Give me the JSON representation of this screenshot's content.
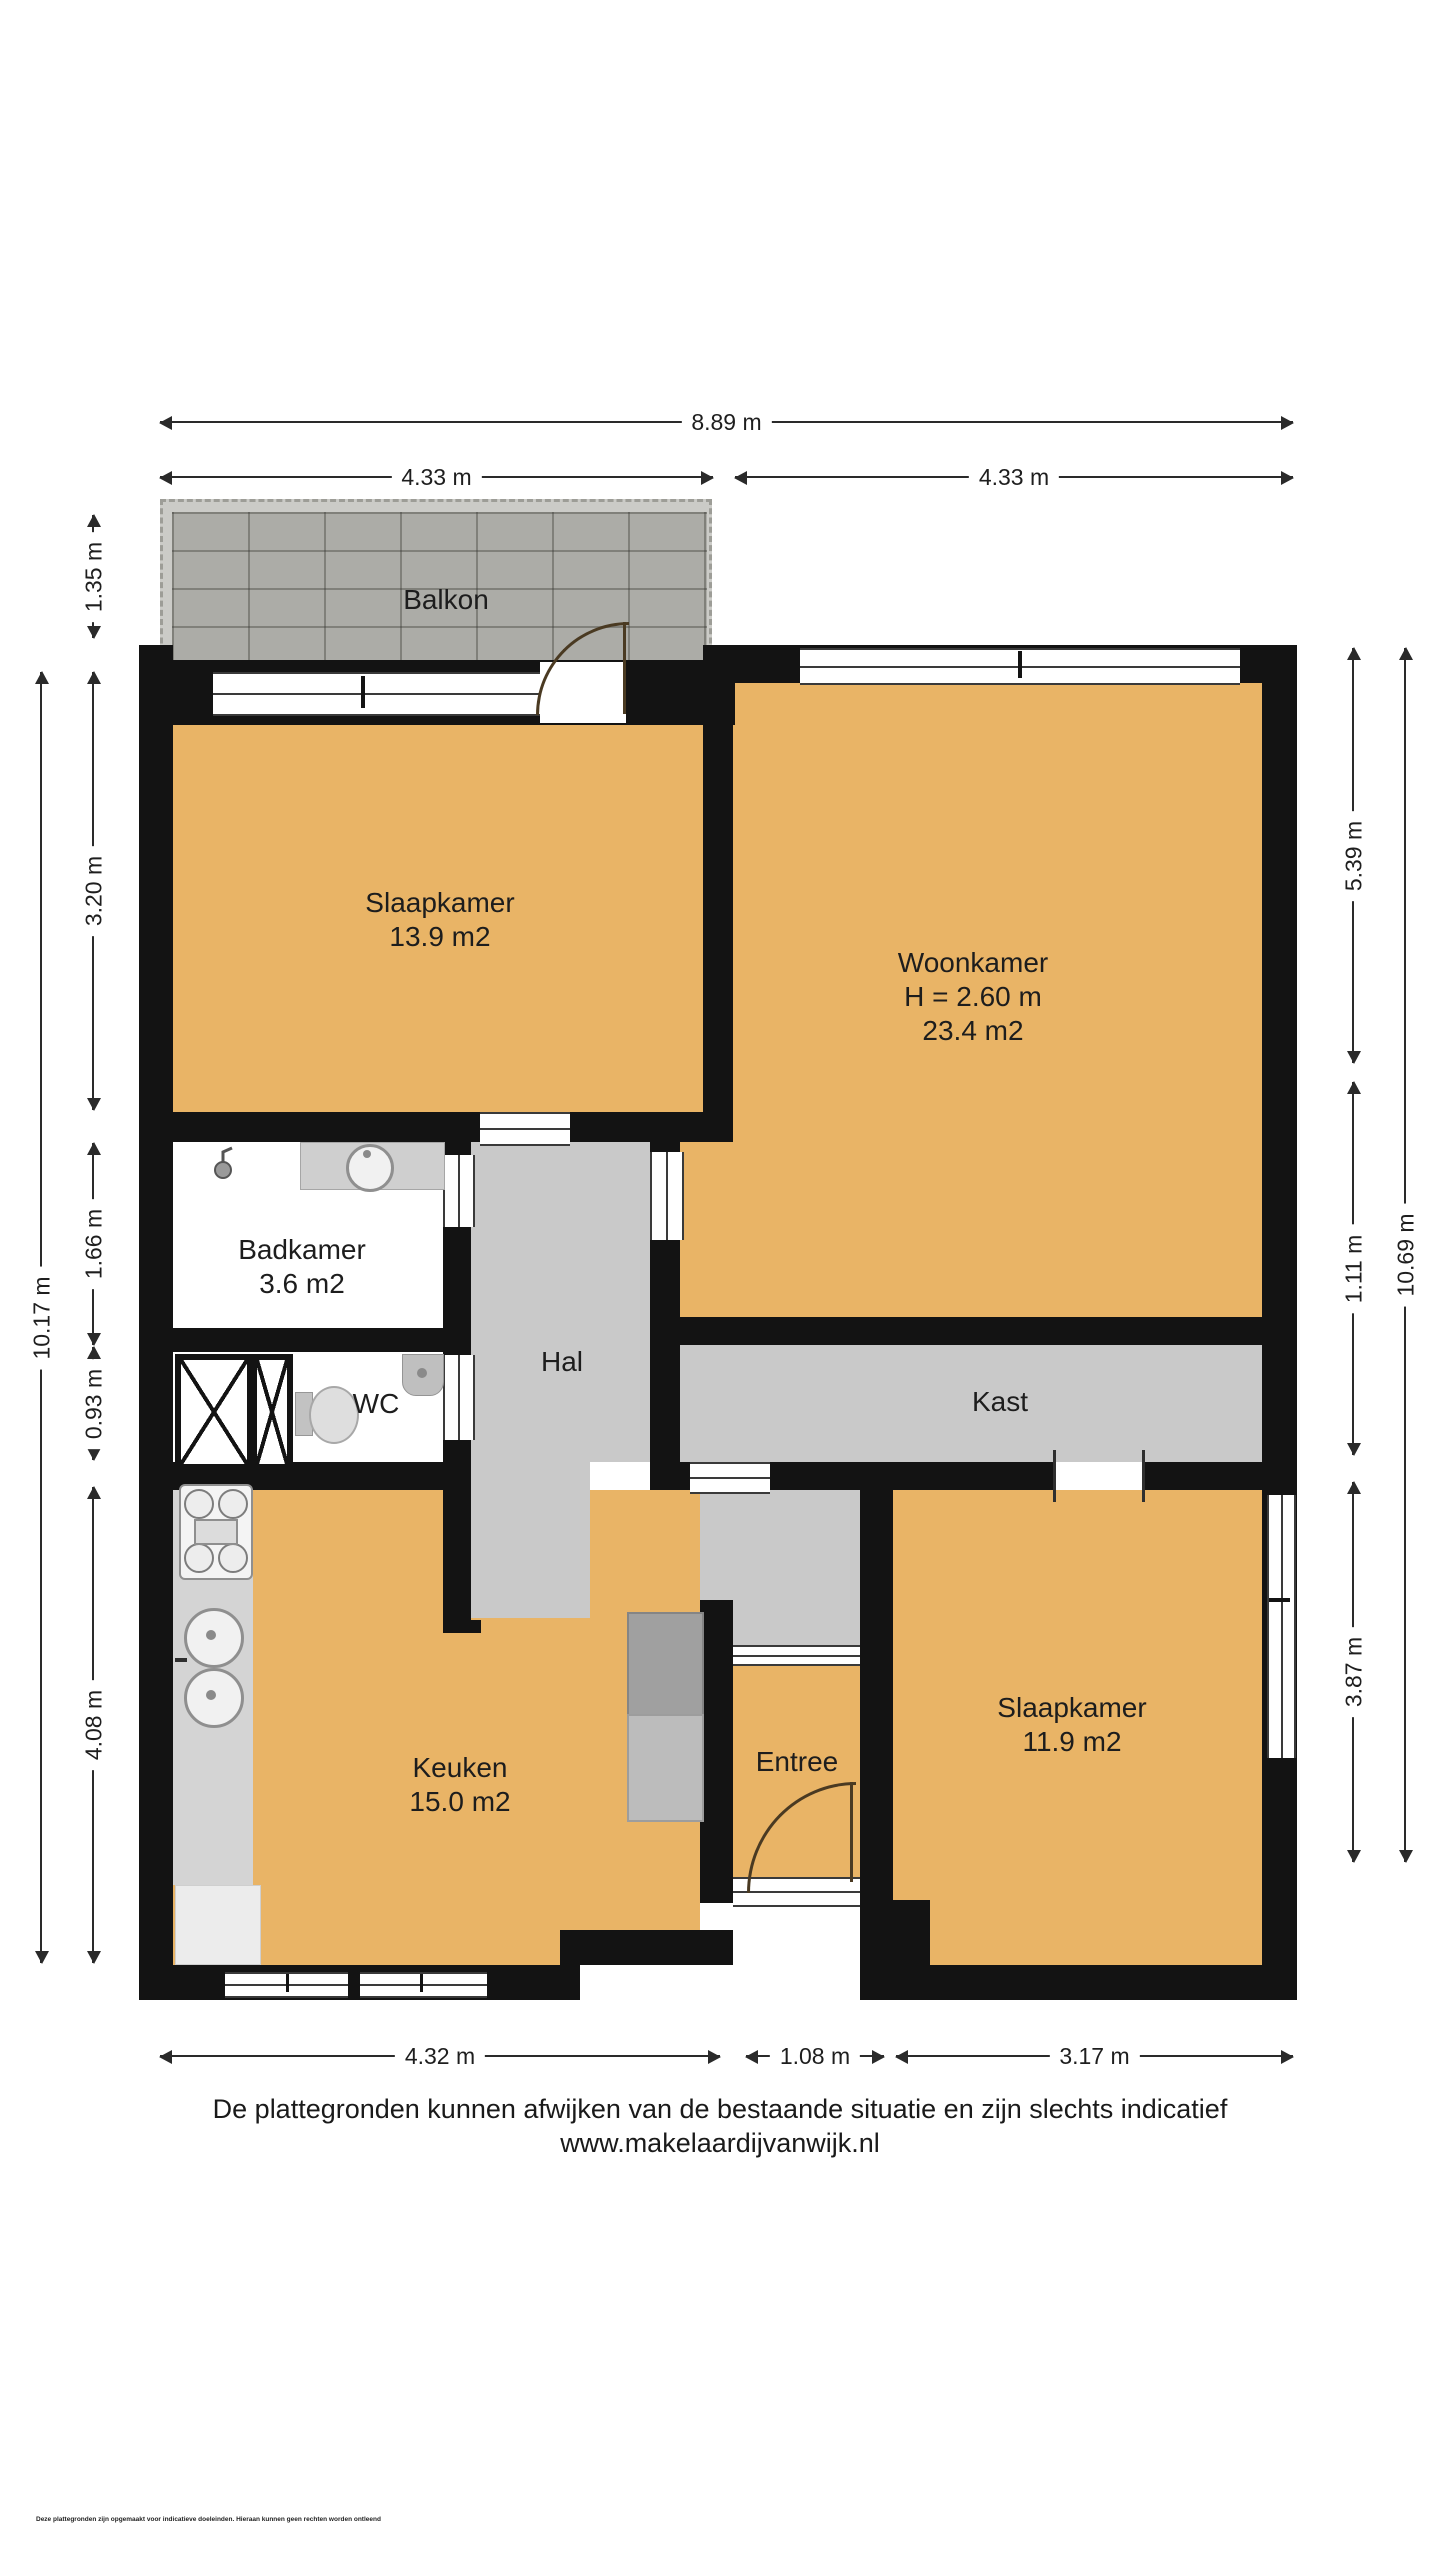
{
  "rooms": {
    "balkon": {
      "label": "Balkon"
    },
    "slaapkamer1": {
      "label": "Slaapkamer",
      "area": "13.9 m2"
    },
    "woonkamer": {
      "label": "Woonkamer",
      "ceiling_height": "H = 2.60 m",
      "area": "23.4 m2"
    },
    "badkamer": {
      "label": "Badkamer",
      "area": "3.6 m2"
    },
    "wc": {
      "label": "WC"
    },
    "hal": {
      "label": "Hal"
    },
    "kast": {
      "label": "Kast"
    },
    "keuken": {
      "label": "Keuken",
      "area": "15.0 m2"
    },
    "entree": {
      "label": "Entree"
    },
    "slaapkamer2": {
      "label": "Slaapkamer",
      "area": "11.9 m2"
    }
  },
  "dimensions": {
    "top_total": "8.89 m",
    "top_left": "4.33 m",
    "top_right": "4.33 m",
    "left_balkon": "1.35 m",
    "left_upper": "3.20 m",
    "left_mid1": "1.66 m",
    "left_mid2": "0.93 m",
    "left_lower": "4.08 m",
    "left_total": "10.17 m",
    "right_upper": "5.39 m",
    "right_mid": "1.11 m",
    "right_lower": "3.87 m",
    "right_total": "10.69 m",
    "bottom_left": "4.32 m",
    "bottom_mid": "1.08 m",
    "bottom_right": "3.17 m"
  },
  "footer": {
    "disclaimer": "De plattegronden kunnen afwijken van de bestaande situatie en zijn slechts indicatief",
    "website": "www.makelaardijvanwijk.nl",
    "fine_print": "Deze plattegronden zijn opgemaakt voor indicatieve doeleinden. Hieraan kunnen geen rechten worden ontleend"
  },
  "colors": {
    "room_floor": "#e9b466",
    "hall_floor": "#c9c9c9",
    "wall": "#131313",
    "balcony_tile": "#acaca7"
  }
}
